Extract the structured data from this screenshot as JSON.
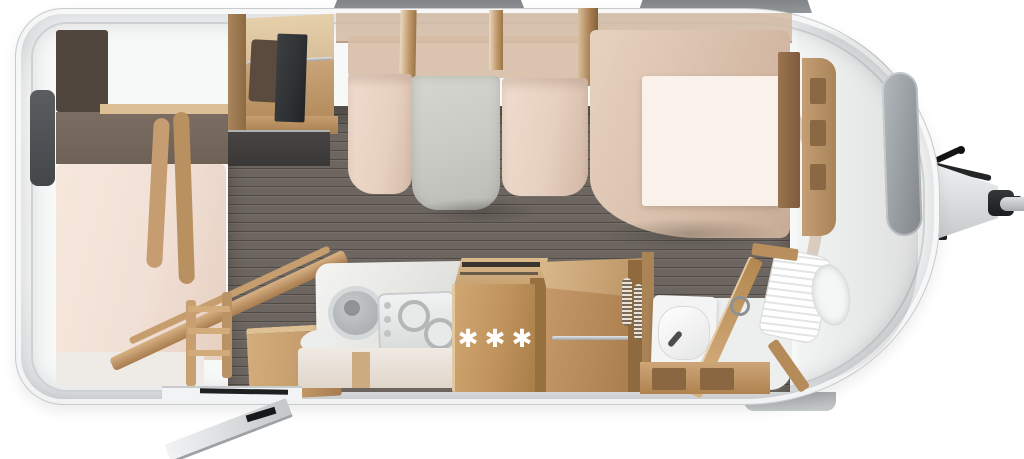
{
  "scene": {
    "description": "Top-down 3D rendered floor plan of a caravan travel trailer",
    "fridge_symbols": "three snowflake marks on refrigerator cabinet"
  },
  "icons": {
    "snowflake": "✱"
  },
  "colors": {
    "body": "#eef0f1",
    "body_edge": "#c7cbce",
    "wall": "#d7dadc",
    "vent": "#85898c",
    "floor": "#6d6660",
    "floor_line": "#5a544f",
    "wood": "#c39a6b",
    "wood_dark": "#96713f",
    "wood_light": "#ddbf95",
    "mattress": "#f1e0d5",
    "bench": "#e6d0c0",
    "backrest": "#d3b9a4",
    "table": "#cbcbc6",
    "bed_mattress": "#f9f1ea",
    "dark_panel": "#3f4347",
    "window": "#969c9f",
    "fixture_white": "#f5f6f6",
    "hitch_dark": "#232526",
    "hitch_light": "#d3d6d8",
    "band_brown": "#6e6156",
    "headboard": "#51463d",
    "counter_dark": "#3a3837",
    "tv": "#2e3134"
  }
}
